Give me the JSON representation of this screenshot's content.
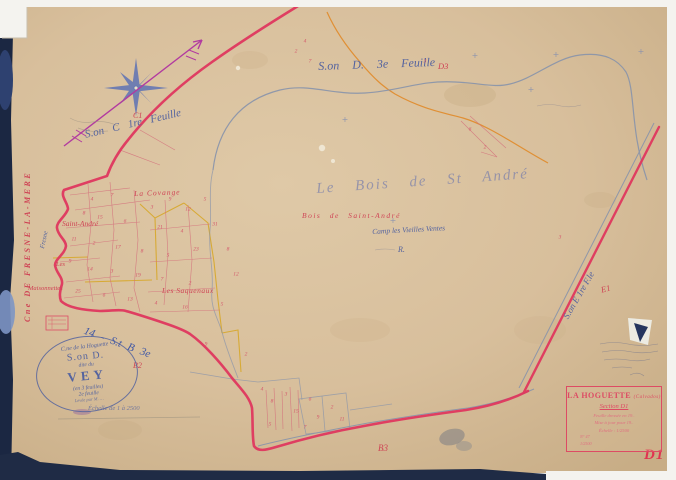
{
  "map": {
    "sheet_code": "D1",
    "labels": {
      "cne_fresne": "Cne DE FRESNE-LA-MERE",
      "fresne_path": "Fresne",
      "son_c": "S.on C  1re Feuille",
      "son_d": "S.on D.   3e   Feuille",
      "son_b": "14 - S.t B 3e",
      "son_e": "S.on E 1re F.le",
      "bois_script": "Le Bois de St André",
      "bois_red": "Bois de Saint-André",
      "camp": "Camp les Vieilles Ventes",
      "r_mark": "R.",
      "la_covange": "La Covange",
      "saint_andre": "Saint-André",
      "les": "Les",
      "maisonnettes": "Maisonnettes",
      "les_saquenaux": "Les Saquenaux",
      "echelle_note": "Échelle de 1 à 2500"
    },
    "refs": {
      "c1": "C1",
      "d3": "D3",
      "b2": "B2",
      "e1": "E1",
      "b3": "B3",
      "d1": "D1"
    },
    "cartouche": {
      "title": "LA HOGUETTE",
      "title_suffix": "(Calvados)",
      "section": "Section D1",
      "lines": [
        "Feuille dressée en 19..",
        "Mise à jour pour 19..",
        "Échelle : 1/2500"
      ],
      "tiny": [
        "N° 47",
        "1/2500"
      ]
    },
    "oval_stamp": {
      "commune": "C.ne de la Hoguette",
      "section": "S.on D.",
      "dite": "dite du",
      "name": "VEY",
      "feuilles": "(en 3 feuilles)",
      "feuille_no": "2e feuille",
      "leve": "Levée par M. …"
    },
    "colors": {
      "boundary_crimson": "#e0335c",
      "path_yellow": "#d7a82b",
      "path_orange": "#e08a28",
      "road_blue": "#8793ab",
      "ink_blue": "#54639f",
      "label_red": "#cf4455",
      "arrow_magenta": "#b23aa0",
      "paper": "#d8bf9c"
    },
    "parcel_numbers": [
      {
        "x": 92,
        "y": 200,
        "t": "4"
      },
      {
        "x": 112,
        "y": 196,
        "t": "7"
      },
      {
        "x": 152,
        "y": 208,
        "t": "3"
      },
      {
        "x": 170,
        "y": 200,
        "t": "9"
      },
      {
        "x": 188,
        "y": 210,
        "t": "12"
      },
      {
        "x": 205,
        "y": 200,
        "t": "5"
      },
      {
        "x": 84,
        "y": 214,
        "t": "8"
      },
      {
        "x": 100,
        "y": 218,
        "t": "15"
      },
      {
        "x": 125,
        "y": 222,
        "t": "6"
      },
      {
        "x": 160,
        "y": 228,
        "t": "21"
      },
      {
        "x": 182,
        "y": 232,
        "t": "4"
      },
      {
        "x": 74,
        "y": 240,
        "t": "11"
      },
      {
        "x": 94,
        "y": 244,
        "t": "2"
      },
      {
        "x": 118,
        "y": 248,
        "t": "17"
      },
      {
        "x": 142,
        "y": 252,
        "t": "8"
      },
      {
        "x": 168,
        "y": 256,
        "t": "5"
      },
      {
        "x": 196,
        "y": 250,
        "t": "23"
      },
      {
        "x": 70,
        "y": 262,
        "t": "9"
      },
      {
        "x": 90,
        "y": 270,
        "t": "14"
      },
      {
        "x": 112,
        "y": 272,
        "t": "3"
      },
      {
        "x": 138,
        "y": 276,
        "t": "19"
      },
      {
        "x": 162,
        "y": 280,
        "t": "7"
      },
      {
        "x": 190,
        "y": 284,
        "t": "2"
      },
      {
        "x": 78,
        "y": 292,
        "t": "25"
      },
      {
        "x": 104,
        "y": 296,
        "t": "6"
      },
      {
        "x": 130,
        "y": 300,
        "t": "13"
      },
      {
        "x": 156,
        "y": 304,
        "t": "4"
      },
      {
        "x": 185,
        "y": 308,
        "t": "16"
      },
      {
        "x": 215,
        "y": 225,
        "t": "31"
      },
      {
        "x": 228,
        "y": 250,
        "t": "8"
      },
      {
        "x": 236,
        "y": 275,
        "t": "12"
      },
      {
        "x": 222,
        "y": 305,
        "t": "5"
      },
      {
        "x": 296,
        "y": 52,
        "t": "2"
      },
      {
        "x": 310,
        "y": 62,
        "t": "7"
      },
      {
        "x": 305,
        "y": 42,
        "t": "4"
      },
      {
        "x": 425,
        "y": 62,
        "t": "3"
      },
      {
        "x": 470,
        "y": 130,
        "t": "6"
      },
      {
        "x": 485,
        "y": 148,
        "t": "2"
      },
      {
        "x": 262,
        "y": 390,
        "t": "4"
      },
      {
        "x": 272,
        "y": 402,
        "t": "8"
      },
      {
        "x": 286,
        "y": 395,
        "t": "3"
      },
      {
        "x": 296,
        "y": 412,
        "t": "15"
      },
      {
        "x": 310,
        "y": 400,
        "t": "6"
      },
      {
        "x": 318,
        "y": 418,
        "t": "9"
      },
      {
        "x": 332,
        "y": 408,
        "t": "2"
      },
      {
        "x": 342,
        "y": 420,
        "t": "11"
      },
      {
        "x": 305,
        "y": 428,
        "t": "7"
      },
      {
        "x": 270,
        "y": 425,
        "t": "5"
      },
      {
        "x": 560,
        "y": 238,
        "t": "3"
      },
      {
        "x": 246,
        "y": 355,
        "t": "2"
      },
      {
        "x": 206,
        "y": 345,
        "t": "9"
      }
    ],
    "survey_crosses": [
      {
        "x": 475,
        "y": 56
      },
      {
        "x": 556,
        "y": 55
      },
      {
        "x": 641,
        "y": 52
      },
      {
        "x": 531,
        "y": 90
      },
      {
        "x": 393,
        "y": 221
      },
      {
        "x": 345,
        "y": 120
      }
    ]
  }
}
